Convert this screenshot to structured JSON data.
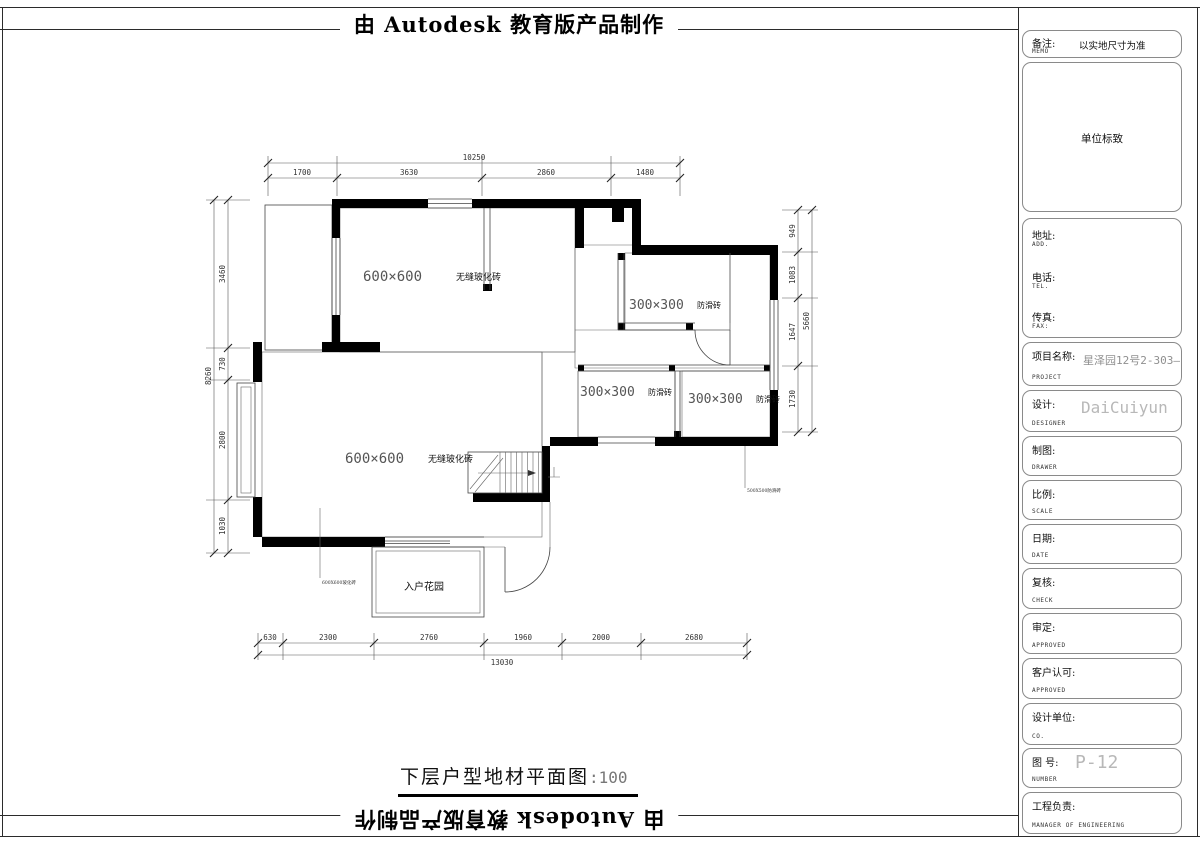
{
  "page": {
    "top_banner": "由 Autodesk 教育版产品制作",
    "bottom_banner": "由 Autodesk 教育版产品制作",
    "drawing_title": "下层户型地材平面图",
    "drawing_scale": ":100"
  },
  "plan": {
    "room_labels": {
      "upper_size": "600×600",
      "upper_name": "无缝玻化砖",
      "living_size": "600×600",
      "living_name": "无缝玻化砖",
      "bath_top_size": "300×300",
      "bath_top_name": "防滑砖",
      "kitchen_size": "300×300",
      "kitchen_name": "防滑砖",
      "bath_right_size": "300×300",
      "bath_right_name": "防滑砖",
      "porch": "入户花园",
      "note_left": "600X600玻化砖",
      "note_right": "500X500防滑砖"
    },
    "dimensions": {
      "top": {
        "overall": "10250",
        "segments": [
          "1700",
          "3630",
          "2860",
          "1480"
        ]
      },
      "bottom": {
        "overall": "13030",
        "segments": [
          "630",
          "2300",
          "2760",
          "1960",
          "2000",
          "2680"
        ]
      },
      "left": {
        "overall": "8260",
        "segments": [
          "3460",
          "730",
          "2800",
          "1030"
        ]
      },
      "right": {
        "overall": "5660",
        "segments": [
          "949",
          "1083",
          "1647",
          "1730"
        ]
      }
    }
  },
  "title_block": {
    "memo": {
      "label": "备注:",
      "sublabel": "MEMO",
      "value": "以实地尺寸为准"
    },
    "logo": {
      "value": "单位标致"
    },
    "address": {
      "label": "地址:",
      "sublabel": "ADD."
    },
    "phone": {
      "label": "电话:",
      "sublabel": "TEL."
    },
    "fax": {
      "label": "传真:",
      "sublabel": "FAX:"
    },
    "project": {
      "label": "项目名称:",
      "sublabel": "PROJECT",
      "value": "星泽园12号2-303—"
    },
    "designer": {
      "label": "设计:",
      "sublabel": "DESIGNER",
      "value": "DaiCuiyun"
    },
    "drawer": {
      "label": "制图:",
      "sublabel": "DRAWER"
    },
    "scale": {
      "label": "比例:",
      "sublabel": "SCALE"
    },
    "date": {
      "label": "日期:",
      "sublabel": "DATE"
    },
    "check": {
      "label": "复核:",
      "sublabel": "CHECK"
    },
    "approve": {
      "label": "审定:",
      "sublabel": "APPROVED"
    },
    "client": {
      "label": "客户认可:",
      "sublabel": "APPROVED"
    },
    "company": {
      "label": "设计单位:",
      "sublabel": "CO."
    },
    "number": {
      "label": "图  号:",
      "sublabel": "NUMBER",
      "value": "P-12"
    },
    "manager": {
      "label": "工程负责:",
      "sublabel": "MANAGER OF ENGINEERING"
    }
  }
}
